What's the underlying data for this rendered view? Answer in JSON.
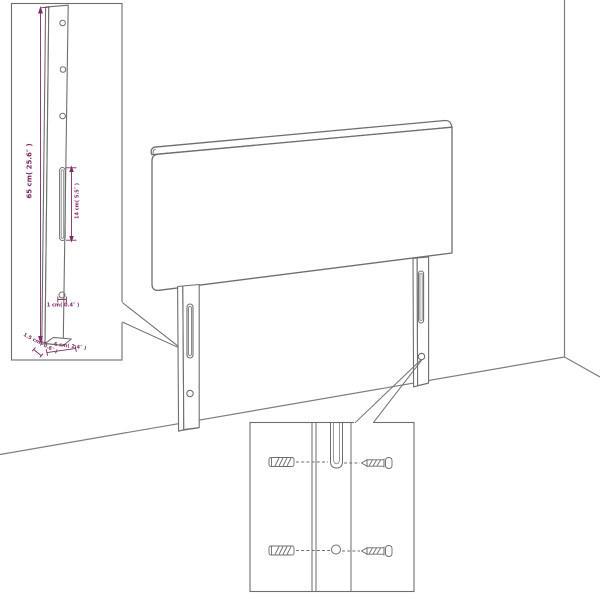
{
  "diagram": {
    "title": "headboard wall-mount assembly diagram",
    "colors": {
      "line": "#6e6e6e",
      "wall_line": "#7e7e7e",
      "dimension": "#7d2d64",
      "background": "#ffffff"
    },
    "insets": {
      "leg_detail": {
        "labels": {
          "height": "65 cm( 25.6″ )",
          "slot": "14 cm( 5.5″ )",
          "hole": "1 cm( 0.4″ )",
          "thickness": "1.5 cm( 0.6″ )",
          "width": "6 cm( 2.4″ )"
        }
      },
      "mounting_detail": {
        "icons": [
          "wall-plug-icon",
          "screw-icon"
        ]
      }
    }
  }
}
